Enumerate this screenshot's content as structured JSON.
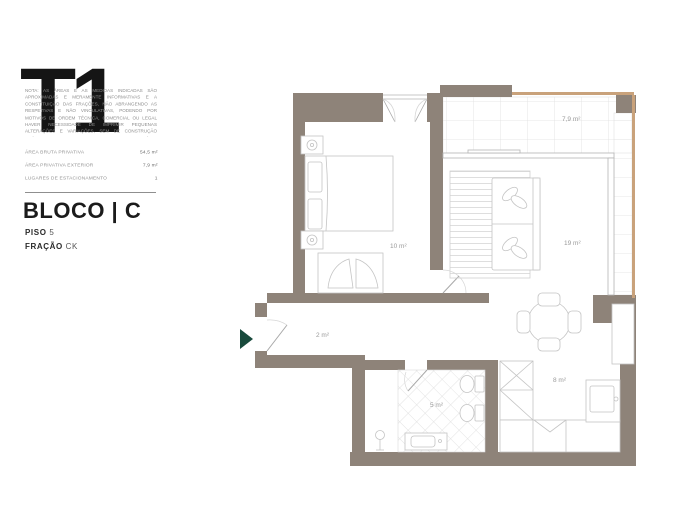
{
  "panel": {
    "title": "T1",
    "disclaimer": "NOTA: AS ÁREAS E AS MEDIDAS INDICADAS SÃO APROXIMADAS E MERAMENTE INFORMATIVAS E A CONSTITUIÇÃO DAS FRAÇÕES, NÃO ABRANGENDO AS RESPETIVAS E NÃO VINCULATIVAS, PODENDO POR MOTIVOS DE ORDEM TÉCNICA, COMERCIAL OU LEGAL HAVER NECESSIDADE DE IMPRIMIR PEQUENAS ALTERAÇÕES E VARIAÇÕES, SEM DE CONSTRUÇÃO PRÉVIOS MODELOS DE ACORDO COM O CRITÉRIO DEFINIDO NA ALÍNEA Q. DO ART.º 8.º DO RJEU, EXCLUÍDA DA ÁREA DE \"COISA ACESSÓRIA\" E JUNTAMENTE COM AS CORRESPONDENTES OBRIGAÇÕES LEGAIS EM VIGOR.",
    "areas": [
      {
        "label": "ÁREA BRUTA PRIVATIVA",
        "value": "54,5 m²"
      },
      {
        "label": "ÁREA PRIVATIVA EXTERIOR",
        "value": "7,9 m²"
      },
      {
        "label": "LUGARES DE ESTACIONAMENTO",
        "value": "1"
      }
    ],
    "bloco_label": "BLOCO | C",
    "piso_label": "PISO",
    "piso_value": "5",
    "fracao_label": "FRAÇÃO",
    "fracao_value": "CK"
  },
  "plan": {
    "rooms": [
      {
        "name": "varanda",
        "area_label": "7,9 m²"
      },
      {
        "name": "quarto",
        "area_label": "10 m²"
      },
      {
        "name": "sala",
        "area_label": "19 m²"
      },
      {
        "name": "hall",
        "area_label": "2 m²"
      },
      {
        "name": "instalacao-sanitaria",
        "area_label": "5 m²"
      },
      {
        "name": "cozinha",
        "area_label": "8 m²"
      }
    ],
    "colors": {
      "wall": "#8e8379",
      "parapet": "#c9a27b",
      "furniture_line": "#c4c4c4",
      "entrance_arrow": "#184a3c"
    }
  }
}
